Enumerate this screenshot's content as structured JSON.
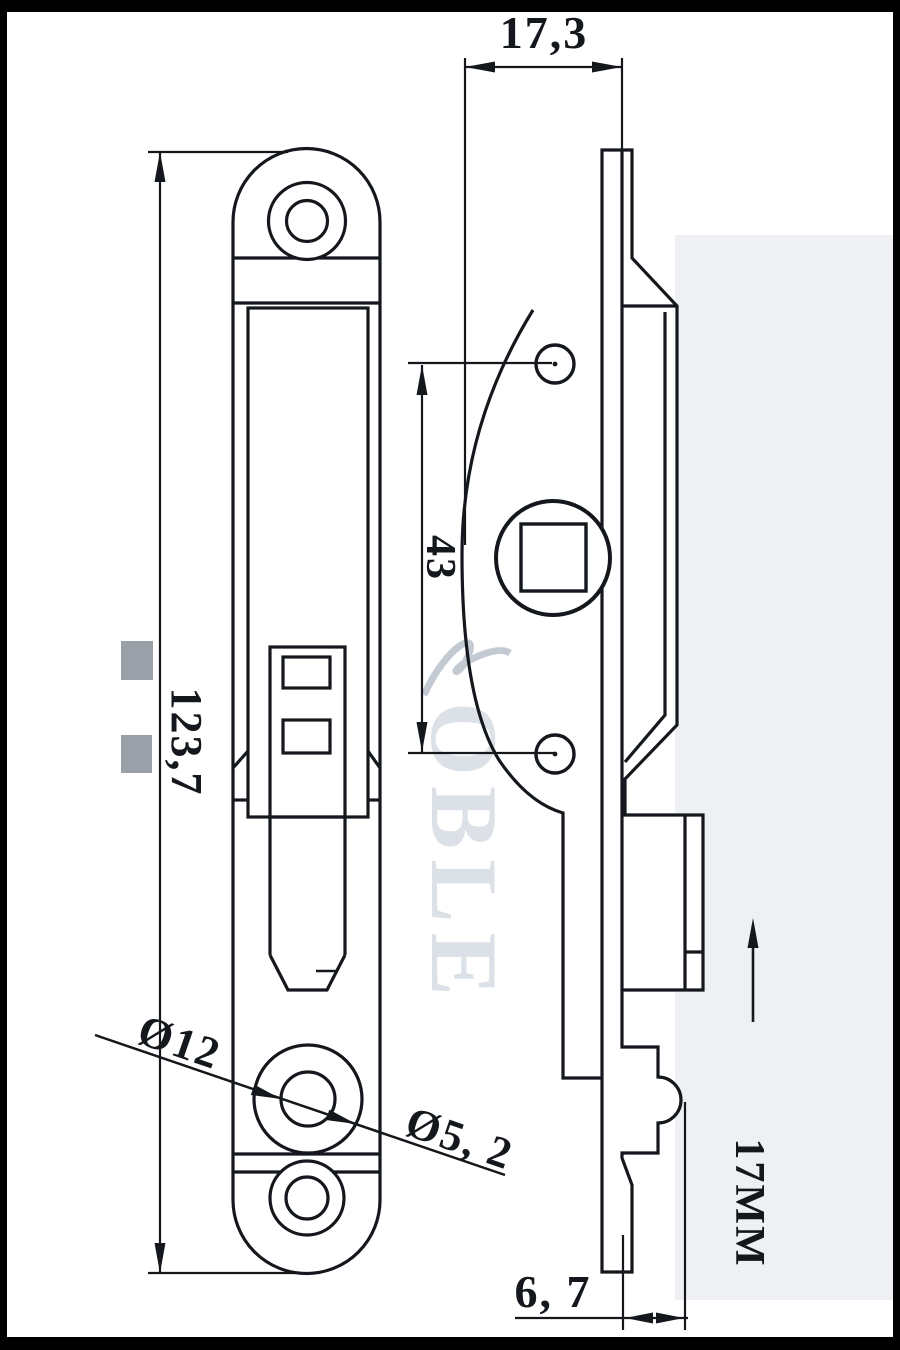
{
  "drawing": {
    "title_hint": "lock-latch-technical-drawing",
    "dimensions": {
      "top_width": "17,3",
      "overall_height": "123,7",
      "hole_spacing": "43",
      "counterbore_diameter": "Ø12",
      "through_hole_diameter": "Ø5, 2",
      "bottom_offset": "6, 7",
      "spindle_label": "17MM"
    },
    "watermark": {
      "text": "OBLE"
    },
    "colors": {
      "line": "#14181c",
      "watermark_light": "#dce1e7",
      "watermark_mid": "#99a0a8",
      "wash": "#eef0f3",
      "frame": "#000000"
    }
  }
}
